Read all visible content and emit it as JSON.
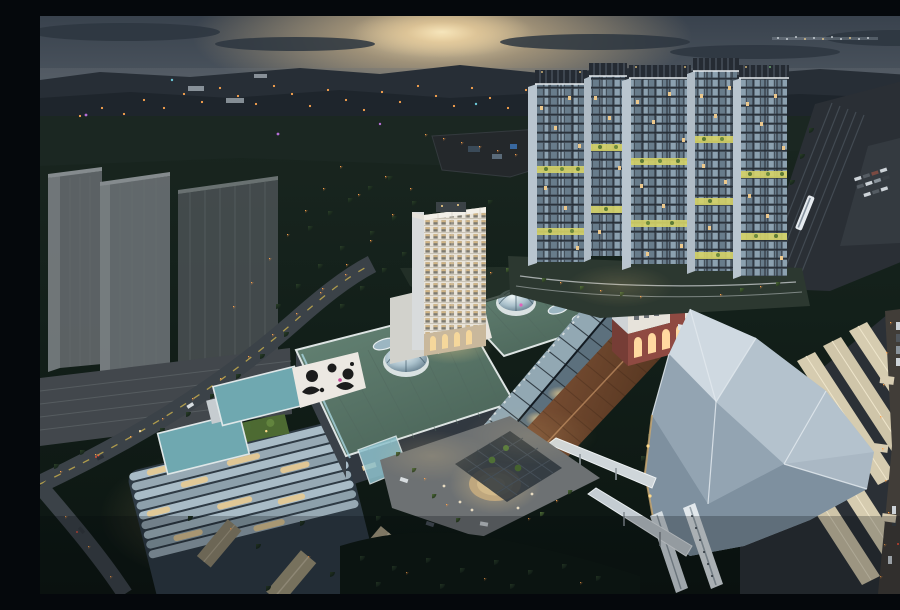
{
  "scene": {
    "type": "aerial architectural rendering",
    "time_of_day": "dusk",
    "description": "Dusk aerial rendering of a transit-oriented mixed-use development: five illuminated residential towers, a shopping mall with sage-green roofs, glass domes and a long gabled glass galleria, a copper-brown market hall, a red-brick heritage block with a chimney, a large white faceted station roof with cream platform canopies and white trains, a terraced green office building, ghosted grey context towers on the left, dark forest, lit suburban streets, a railway corridor, and a warm sunset glow on the mountain horizon.",
    "counts": {
      "residential_towers": 5,
      "glass_domes": 3,
      "roof_skylights": 4,
      "platform_canopies": 5,
      "trains": 3,
      "ghost_context_towers": 3
    },
    "palette": {
      "sky_top": "#39424d",
      "sunset_glow": "#f5e3b8",
      "mountain": "#272e36",
      "forest": "#14211a",
      "mall_roof": "#5d7a6e",
      "atrium_glass": "#8ea4b0",
      "brown_roof": "#7a4c30",
      "brick": "#8f4a42",
      "station_roof": "#aab8c4",
      "platform_canopy": "#d6ccb0",
      "tower_glass": "#8ca1b0",
      "warm_window": "#ecc88c",
      "street_light": "#ff9a45",
      "teal_roof_deck": "#6fa8b0",
      "terrace_green": "#4d6a32",
      "ghost_tower_grey": "#5f6568"
    },
    "lighting": {
      "street_lights": "orange sodium dots along roads and paths",
      "windows": "mix of warm amber and cool blue lit windows",
      "sky_gardens": "yellow-green glowing garden bands on tower facades",
      "horizon": "cream sunset glow breaking over dark ridges"
    }
  }
}
